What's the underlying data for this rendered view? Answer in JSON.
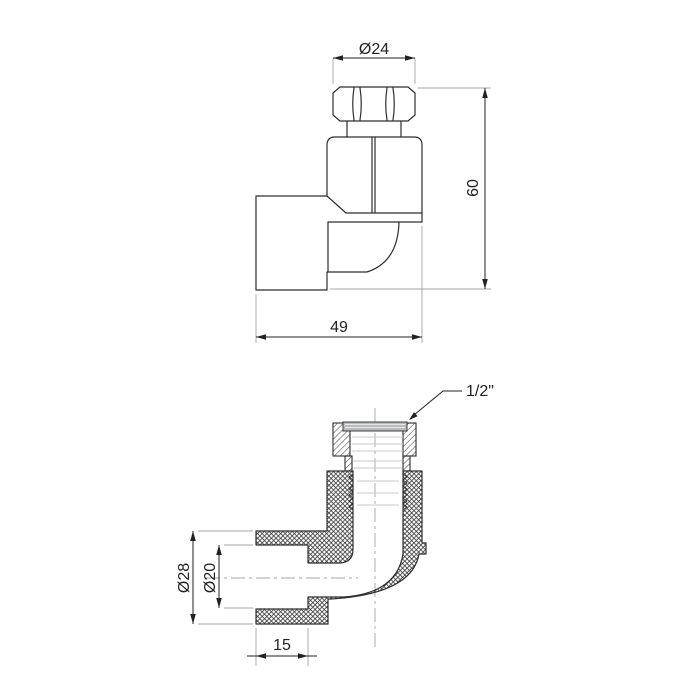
{
  "colors": {
    "background": "#ffffff",
    "outline": "#2e2e2e",
    "dimension": "#222222",
    "auxiliary_line": "#a6a6a6",
    "thread_fill": "#b9bcbe"
  },
  "top_view": {
    "labels": {
      "nut_width_across_flats": "Ø24",
      "overall_height": "60",
      "overall_width": "49"
    }
  },
  "section_view": {
    "labels": {
      "thread_size": "1/2\"",
      "socket_outer_diameter": "Ø28",
      "socket_inner_diameter": "Ø20",
      "socket_depth": "15"
    }
  }
}
